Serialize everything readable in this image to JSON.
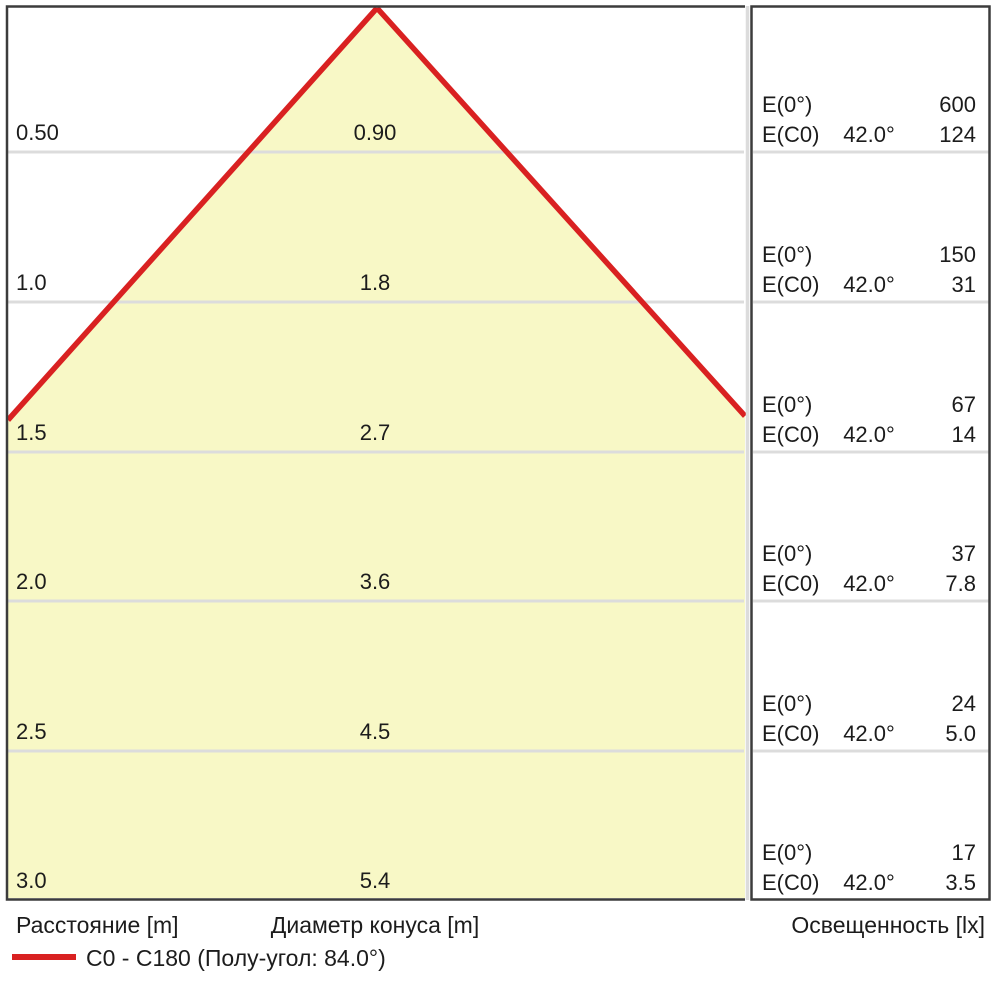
{
  "colors": {
    "cone-fill": "#f8f8c6",
    "accent-red": "#d92121",
    "grid-line": "#dcdcdc",
    "border-dark": "#3c3c3c",
    "text": "#1c1c1c"
  },
  "axis": {
    "distance_label": "Расстояние [m]",
    "diameter_label": "Диаметр конуса [m]",
    "illuminance_label": "Освещенность [lx]"
  },
  "legend": {
    "label": "C0 - C180 (Полу-угол: 84.0°)"
  },
  "panel_labels": {
    "e0": "E(0°)",
    "ec0": "E(C0)"
  },
  "rows": [
    {
      "distance": "0.50",
      "diameter": "0.90",
      "e0": "600",
      "angle": "42.0°",
      "ec0": "124"
    },
    {
      "distance": "1.0",
      "diameter": "1.8",
      "e0": "150",
      "angle": "42.0°",
      "ec0": "31"
    },
    {
      "distance": "1.5",
      "diameter": "2.7",
      "e0": "67",
      "angle": "42.0°",
      "ec0": "14"
    },
    {
      "distance": "2.0",
      "diameter": "3.6",
      "e0": "37",
      "angle": "42.0°",
      "ec0": "7.8"
    },
    {
      "distance": "2.5",
      "diameter": "4.5",
      "e0": "24",
      "angle": "42.0°",
      "ec0": "5.0"
    },
    {
      "distance": "3.0",
      "diameter": "5.4",
      "e0": "17",
      "angle": "42.0°",
      "ec0": "3.5"
    }
  ],
  "chart_data": {
    "type": "area",
    "subtype": "photometric_cone_diagram",
    "title": "",
    "x_distances_m": [
      0.5,
      1.0,
      1.5,
      2.0,
      2.5,
      3.0
    ],
    "series": [
      {
        "name": "Диаметр конуса [m]",
        "values": [
          0.9,
          1.8,
          2.7,
          3.6,
          4.5,
          5.4
        ]
      },
      {
        "name": "E(0°) [lx]",
        "values": [
          600,
          150,
          67,
          37,
          24,
          17
        ]
      },
      {
        "name": "E(C0) [lx] при 42.0°",
        "values": [
          124,
          31,
          14,
          7.8,
          5.0,
          3.5
        ]
      }
    ],
    "legend": [
      {
        "label": "C0 - C180 (Полу-угол: 84.0°)",
        "color": "#d92121"
      }
    ],
    "beam": {
      "c_planes": "C0 - C180",
      "half_angle_deg": 84.0,
      "ec0_angle_deg": 42.0
    },
    "axes": {
      "distance": "Расстояние [m]",
      "cone_diameter": "Диаметр конуса [m]",
      "illuminance": "Освещенность [lx]"
    },
    "grid": true,
    "legend_position": "bottom-left"
  }
}
